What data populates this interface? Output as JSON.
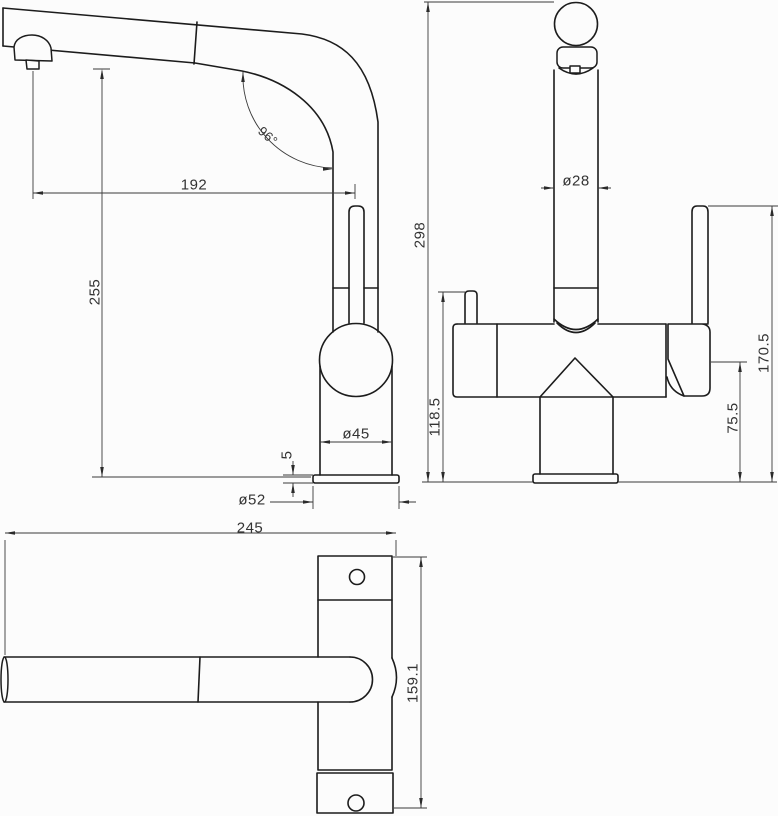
{
  "drawing": {
    "type": "technical-dimension-drawing",
    "subject": "kitchen-mixer-tap",
    "views": [
      {
        "id": "side-view"
      },
      {
        "id": "front-view"
      },
      {
        "id": "top-view"
      }
    ]
  },
  "labels": {
    "spout_reach": "192",
    "spout_angle": "96°",
    "spout_clearance": "255",
    "body_diameter": "ø45",
    "base_plate_thickness": "5",
    "base_plate_diameter": "ø52",
    "overall_height": "298",
    "spout_tube_diameter": "ø28",
    "side_knob_height": "118.5",
    "handle_hub_height": "75.5",
    "lever_top_height": "170.5",
    "overall_length": "245",
    "body_depth": "159.1"
  },
  "colors": {
    "background": "#fcfcfc",
    "line": "#1c1c1c",
    "dimension_line": "#3a3a3a",
    "text": "#333333"
  }
}
